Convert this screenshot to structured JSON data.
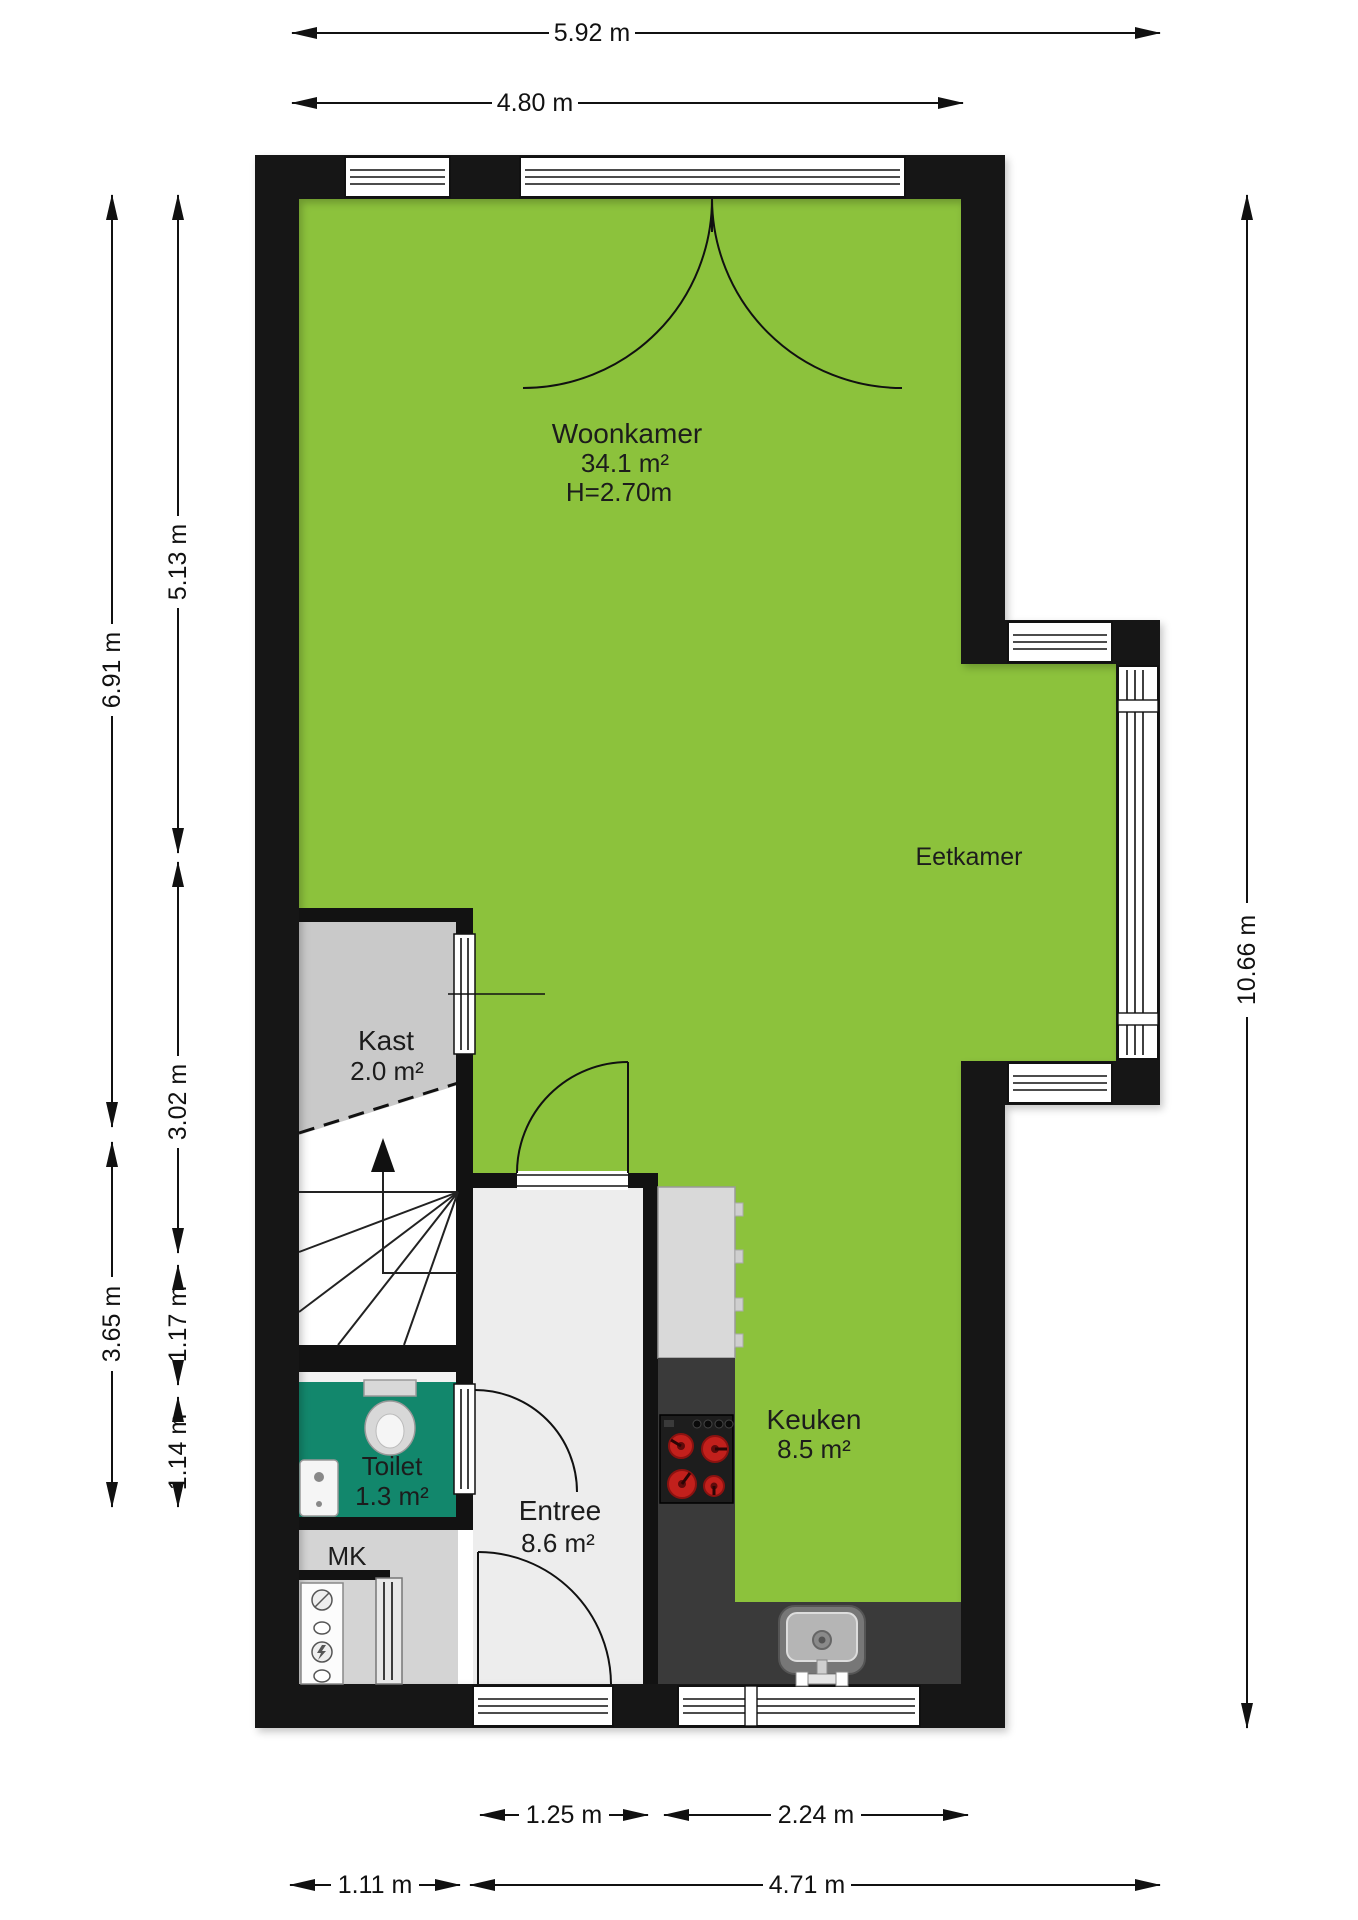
{
  "colors": {
    "floor_green": "#8cc23c",
    "toilet_teal": "#12876c",
    "kast_gray": "#c9c9c9",
    "entree_gray": "#ededed",
    "mk_gray": "#d4d4d4",
    "wall_black": "#121212",
    "counter_dark": "#3a3a3a",
    "cabinet_gray": "#d9d9d9",
    "burner_red": "#c2201c"
  },
  "rooms": {
    "woonkamer": {
      "name": "Woonkamer",
      "area": "34.1 m²",
      "ceiling": "H=2.70m"
    },
    "eetkamer": {
      "name": "Eetkamer"
    },
    "kast": {
      "name": "Kast",
      "area": "2.0 m²"
    },
    "toilet": {
      "name": "Toilet",
      "area": "1.3 m²"
    },
    "mk": {
      "name": "MK"
    },
    "entree": {
      "name": "Entree",
      "area": "8.6 m²"
    },
    "keuken": {
      "name": "Keuken",
      "area": "8.5 m²"
    }
  },
  "dimensions": {
    "top_total": "5.92 m",
    "top_main": "4.80 m",
    "left_upper_outer": "6.91 m",
    "left_lower_outer": "3.65 m",
    "left_upper_inner": "5.13 m",
    "left_mid_inner": "3.02 m",
    "left_toilet_inner": "1.17 m",
    "left_mk_inner": "1.14 m",
    "right_total": "10.66 m",
    "bottom_door": "1.25 m",
    "bottom_kitchen": "2.24 m",
    "bottom_left": "1.11 m",
    "bottom_main": "4.71 m"
  }
}
